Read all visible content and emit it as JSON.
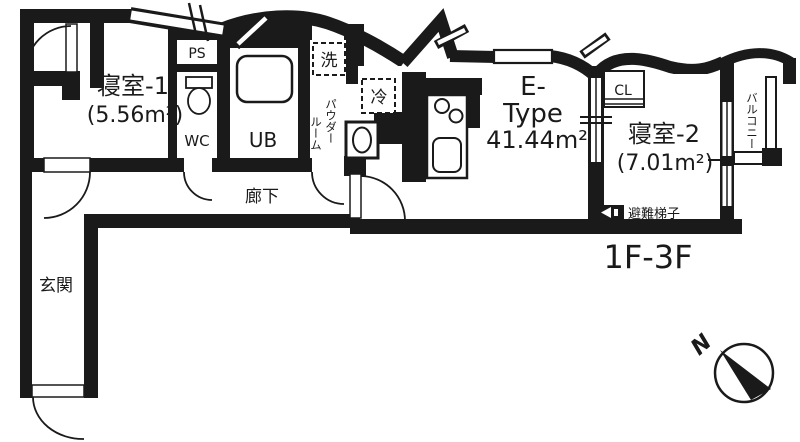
{
  "floor_plan": {
    "unit": {
      "type_line1": "E-",
      "type_line2": "Type",
      "area": "41.44m²",
      "floor_range": "1F-3F"
    },
    "rooms": {
      "bedroom1": {
        "label": "寝室-1",
        "area": "(5.56m²)"
      },
      "bedroom2": {
        "label": "寝室-2",
        "area": "(7.01m²)"
      },
      "corridor": "廊下",
      "entrance": "玄関",
      "balcony": "バルコニー",
      "powder_room_col1": "パウダー",
      "powder_room_col2": "ルーム",
      "toilet": "WC",
      "unit_bath": "UB",
      "pipe_space": "PS",
      "closet": "CL",
      "washer_space": "洗",
      "refrigerator_space": "冷",
      "evacuation_ladder": "避難梯子"
    },
    "compass": {
      "north": "N"
    },
    "colors": {
      "wall": "#1a1a1a",
      "background": "#ffffff"
    }
  }
}
